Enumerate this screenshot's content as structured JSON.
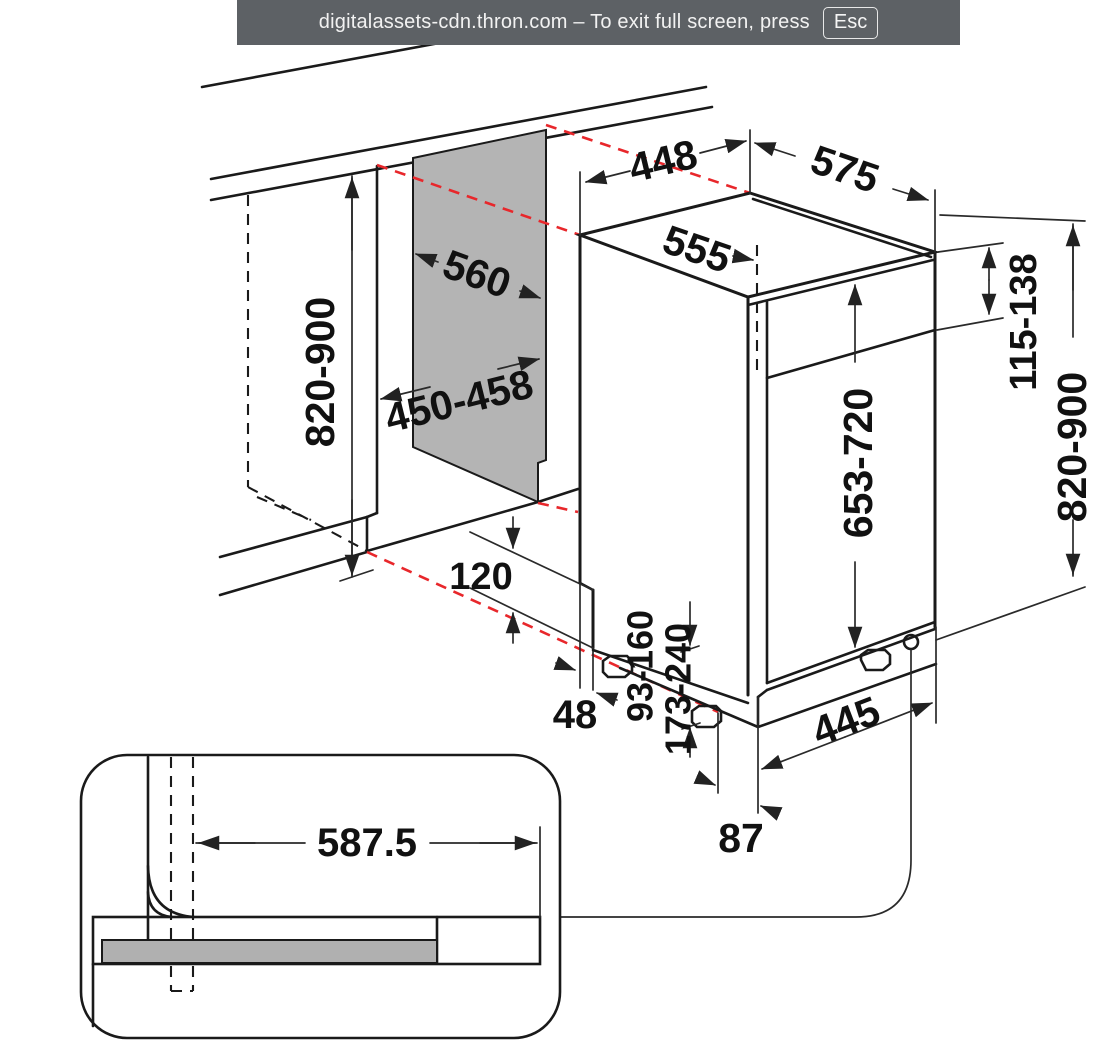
{
  "window": {
    "fullscreen_toast": {
      "message": "digitalassets-cdn.thron.com – To exit full screen, press",
      "key": "Esc",
      "background_color": "#5d6165",
      "text_color": "#f2f2f2"
    }
  },
  "diagram": {
    "kind": "appliance-installation-dimension-drawing",
    "colors": {
      "line": "#1a1a1a",
      "projection_dashed": "#e8272b",
      "niche_panel_fill": "#b4b4b4",
      "plinth_bar_fill": "#b0b0b0"
    },
    "labels": {
      "niche_depth": "560",
      "niche_width": "450-458",
      "niche_height": "820-900",
      "top_width": "448",
      "top_depth_total": "575",
      "top_depth_rear": "555",
      "control_band_height": "115-138",
      "overall_height": "820-900",
      "door_height": "653-720",
      "plinth_recess": "120",
      "rear_gap": "48",
      "clearance_min": "93-160",
      "clearance_max": "173-240",
      "bottom_width": "445",
      "bottom_offset": "87",
      "hose_offset": "587.5"
    }
  }
}
